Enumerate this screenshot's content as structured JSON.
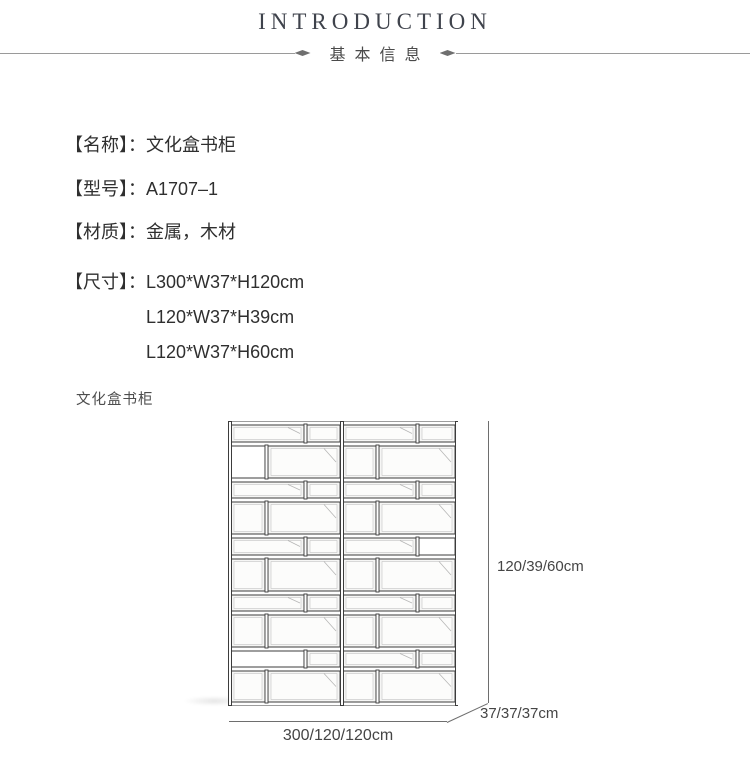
{
  "header": {
    "title": "INTRODUCTION",
    "subtitle": "基本信息"
  },
  "specs": [
    {
      "label": "【名称】：",
      "value": "文化盒书柜"
    },
    {
      "label": "【型号】：",
      "value": "A1707–1"
    },
    {
      "label": "【材质】：",
      "value": "金属，木材"
    },
    {
      "label": "【尺寸】：",
      "values": [
        "L300*W37*H120cm",
        "L120*W37*H39cm",
        "L120*W37*H60cm"
      ]
    }
  ],
  "figure": {
    "caption": "文化盒书柜",
    "height_label": "120/39/60cm",
    "depth_label": "37/37/37cm",
    "width_label": "300/120/120cm"
  },
  "colors": {
    "title_text": "#3f434c",
    "body_text": "#2f2f2f",
    "divider_line": "#9a9a9a",
    "dimension_line": "#6e6e6e",
    "drawing_stroke": "#3c3c3c"
  }
}
